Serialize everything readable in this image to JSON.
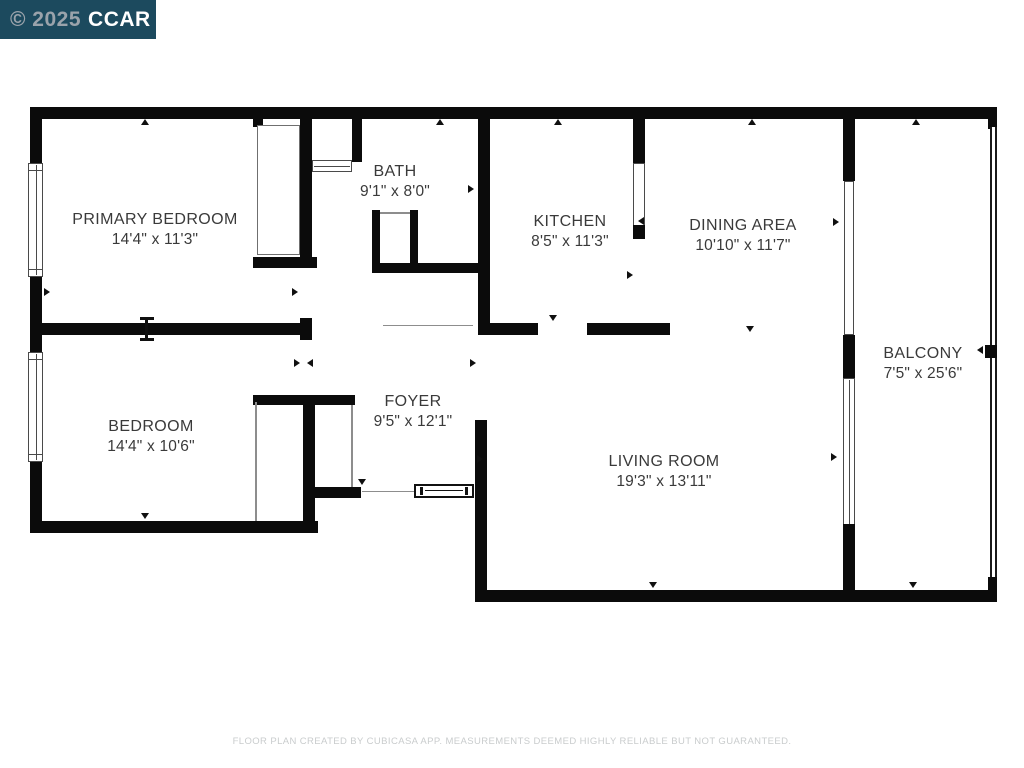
{
  "watermark": {
    "copyright": "© 2025",
    "brand": "CCAR",
    "bg_color": "#1c4a5e",
    "copyright_color": "#9aa3ab",
    "brand_color": "#ffffff"
  },
  "floor_plan": {
    "wall_color": "#0b0b0b",
    "background_color": "#ffffff",
    "label_color": "#3a3a3a",
    "rooms": [
      {
        "name": "PRIMARY BEDROOM",
        "dimensions": "14'4\" x 11'3\""
      },
      {
        "name": "BATH",
        "dimensions": "9'1\" x 8'0\""
      },
      {
        "name": "KITCHEN",
        "dimensions": "8'5\" x 11'3\""
      },
      {
        "name": "DINING AREA",
        "dimensions": "10'10\" x 11'7\""
      },
      {
        "name": "BALCONY",
        "dimensions": "7'5\" x 25'6\""
      },
      {
        "name": "BEDROOM",
        "dimensions": "14'4\" x 10'6\""
      },
      {
        "name": "FOYER",
        "dimensions": "9'5\" x 12'1\""
      },
      {
        "name": "LIVING ROOM",
        "dimensions": "19'3\" x 13'11\""
      }
    ]
  },
  "footer": {
    "disclaimer": "FLOOR PLAN CREATED BY CUBICASA APP. MEASUREMENTS DEEMED HIGHLY RELIABLE BUT NOT GUARANTEED."
  }
}
